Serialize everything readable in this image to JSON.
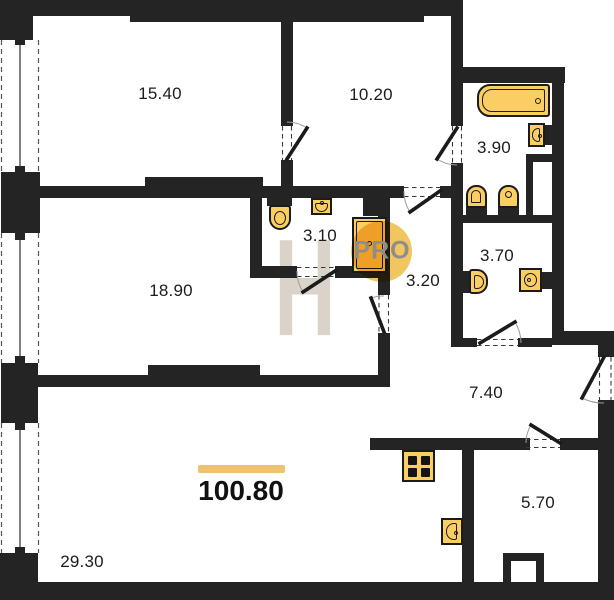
{
  "plan": {
    "total_area": "100.80",
    "rooms": {
      "bedroom_top_left": "15.40",
      "bedroom_top_right": "10.20",
      "bathroom_top": "3.90",
      "shower_wc": "3.10",
      "inner_hall": "3.20",
      "bathroom_small": "3.70",
      "bedroom_left": "18.90",
      "hallway": "7.40",
      "pantry": "5.70",
      "living_kitchen": "29.30"
    },
    "watermark": {
      "letter": "H",
      "brand": "PRO"
    },
    "colors": {
      "wall": "#242424",
      "fixture": "#fbce63",
      "fixtureBorder": "#1b1b1b",
      "accentBar": "#efc271",
      "circle": "#f0bd4a",
      "watermarkLetter": "#d9d3ca",
      "watermarkText": "#8e8d8b"
    }
  }
}
